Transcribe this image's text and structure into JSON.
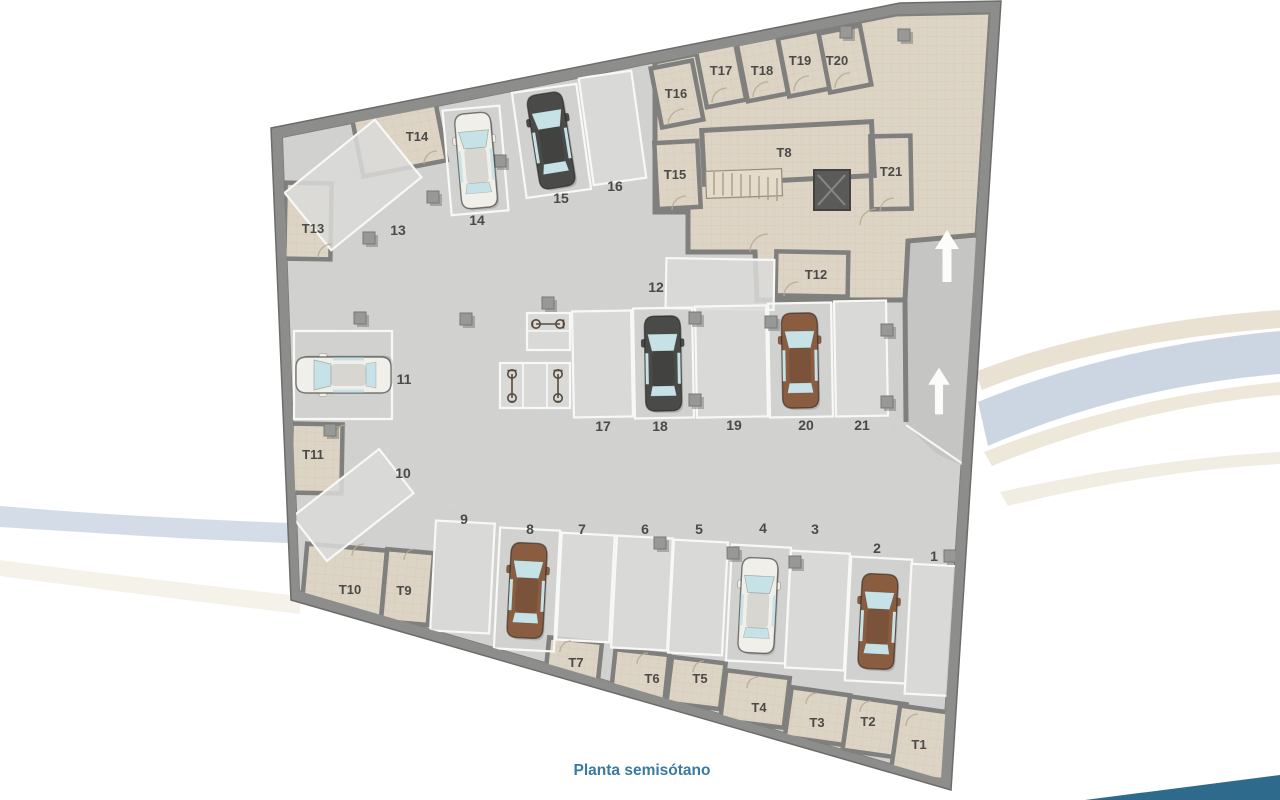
{
  "plan": {
    "caption": "Planta semisótano",
    "parking_spaces": {
      "p1": "1",
      "p2": "2",
      "p3": "3",
      "p4": "4",
      "p5": "5",
      "p6": "6",
      "p7": "7",
      "p8": "8",
      "p9": "9",
      "p10": "10",
      "p11": "11",
      "p12": "12",
      "p13": "13",
      "p14": "14",
      "p15": "15",
      "p16": "16",
      "p17": "17",
      "p18": "18",
      "p19": "19",
      "p20": "20",
      "p21": "21"
    },
    "storage_rooms": {
      "t1": "T1",
      "t2": "T2",
      "t3": "T3",
      "t4": "T4",
      "t5": "T5",
      "t6": "T6",
      "t7": "T7",
      "t8": "T8",
      "t9": "T9",
      "t10": "T10",
      "t11": "T11",
      "t12": "T12",
      "t13": "T13",
      "t14": "T14",
      "t15": "T15",
      "t16": "T16",
      "t17": "T17",
      "t18": "T18",
      "t19": "T19",
      "t20": "T20",
      "t21": "T21"
    }
  },
  "icons": {
    "ramp_arrow": "up-arrow-icon",
    "bicycle": "bicycle-icon",
    "car": "car-top-view-icon",
    "elevator": "elevator-icon",
    "stairs": "stairs-icon"
  },
  "colors": {
    "caption_text": "#3a7aa1",
    "label_text": "#4a4a48",
    "outer_wall": "#8d8d8b",
    "garage_floor": "#d2d2d0",
    "storage_floor": "#ded5c5",
    "ramp": "#c6c6c4",
    "parking_line": "#f8f8f6",
    "corner_wedge": "#2d6a8c",
    "swoosh_blue": "#ccd6e3",
    "swoosh_beige": "#e9e2d3",
    "car_white": "#f0efe9",
    "car_dark": "#4a4a48",
    "car_brown": "#8a5d41"
  }
}
